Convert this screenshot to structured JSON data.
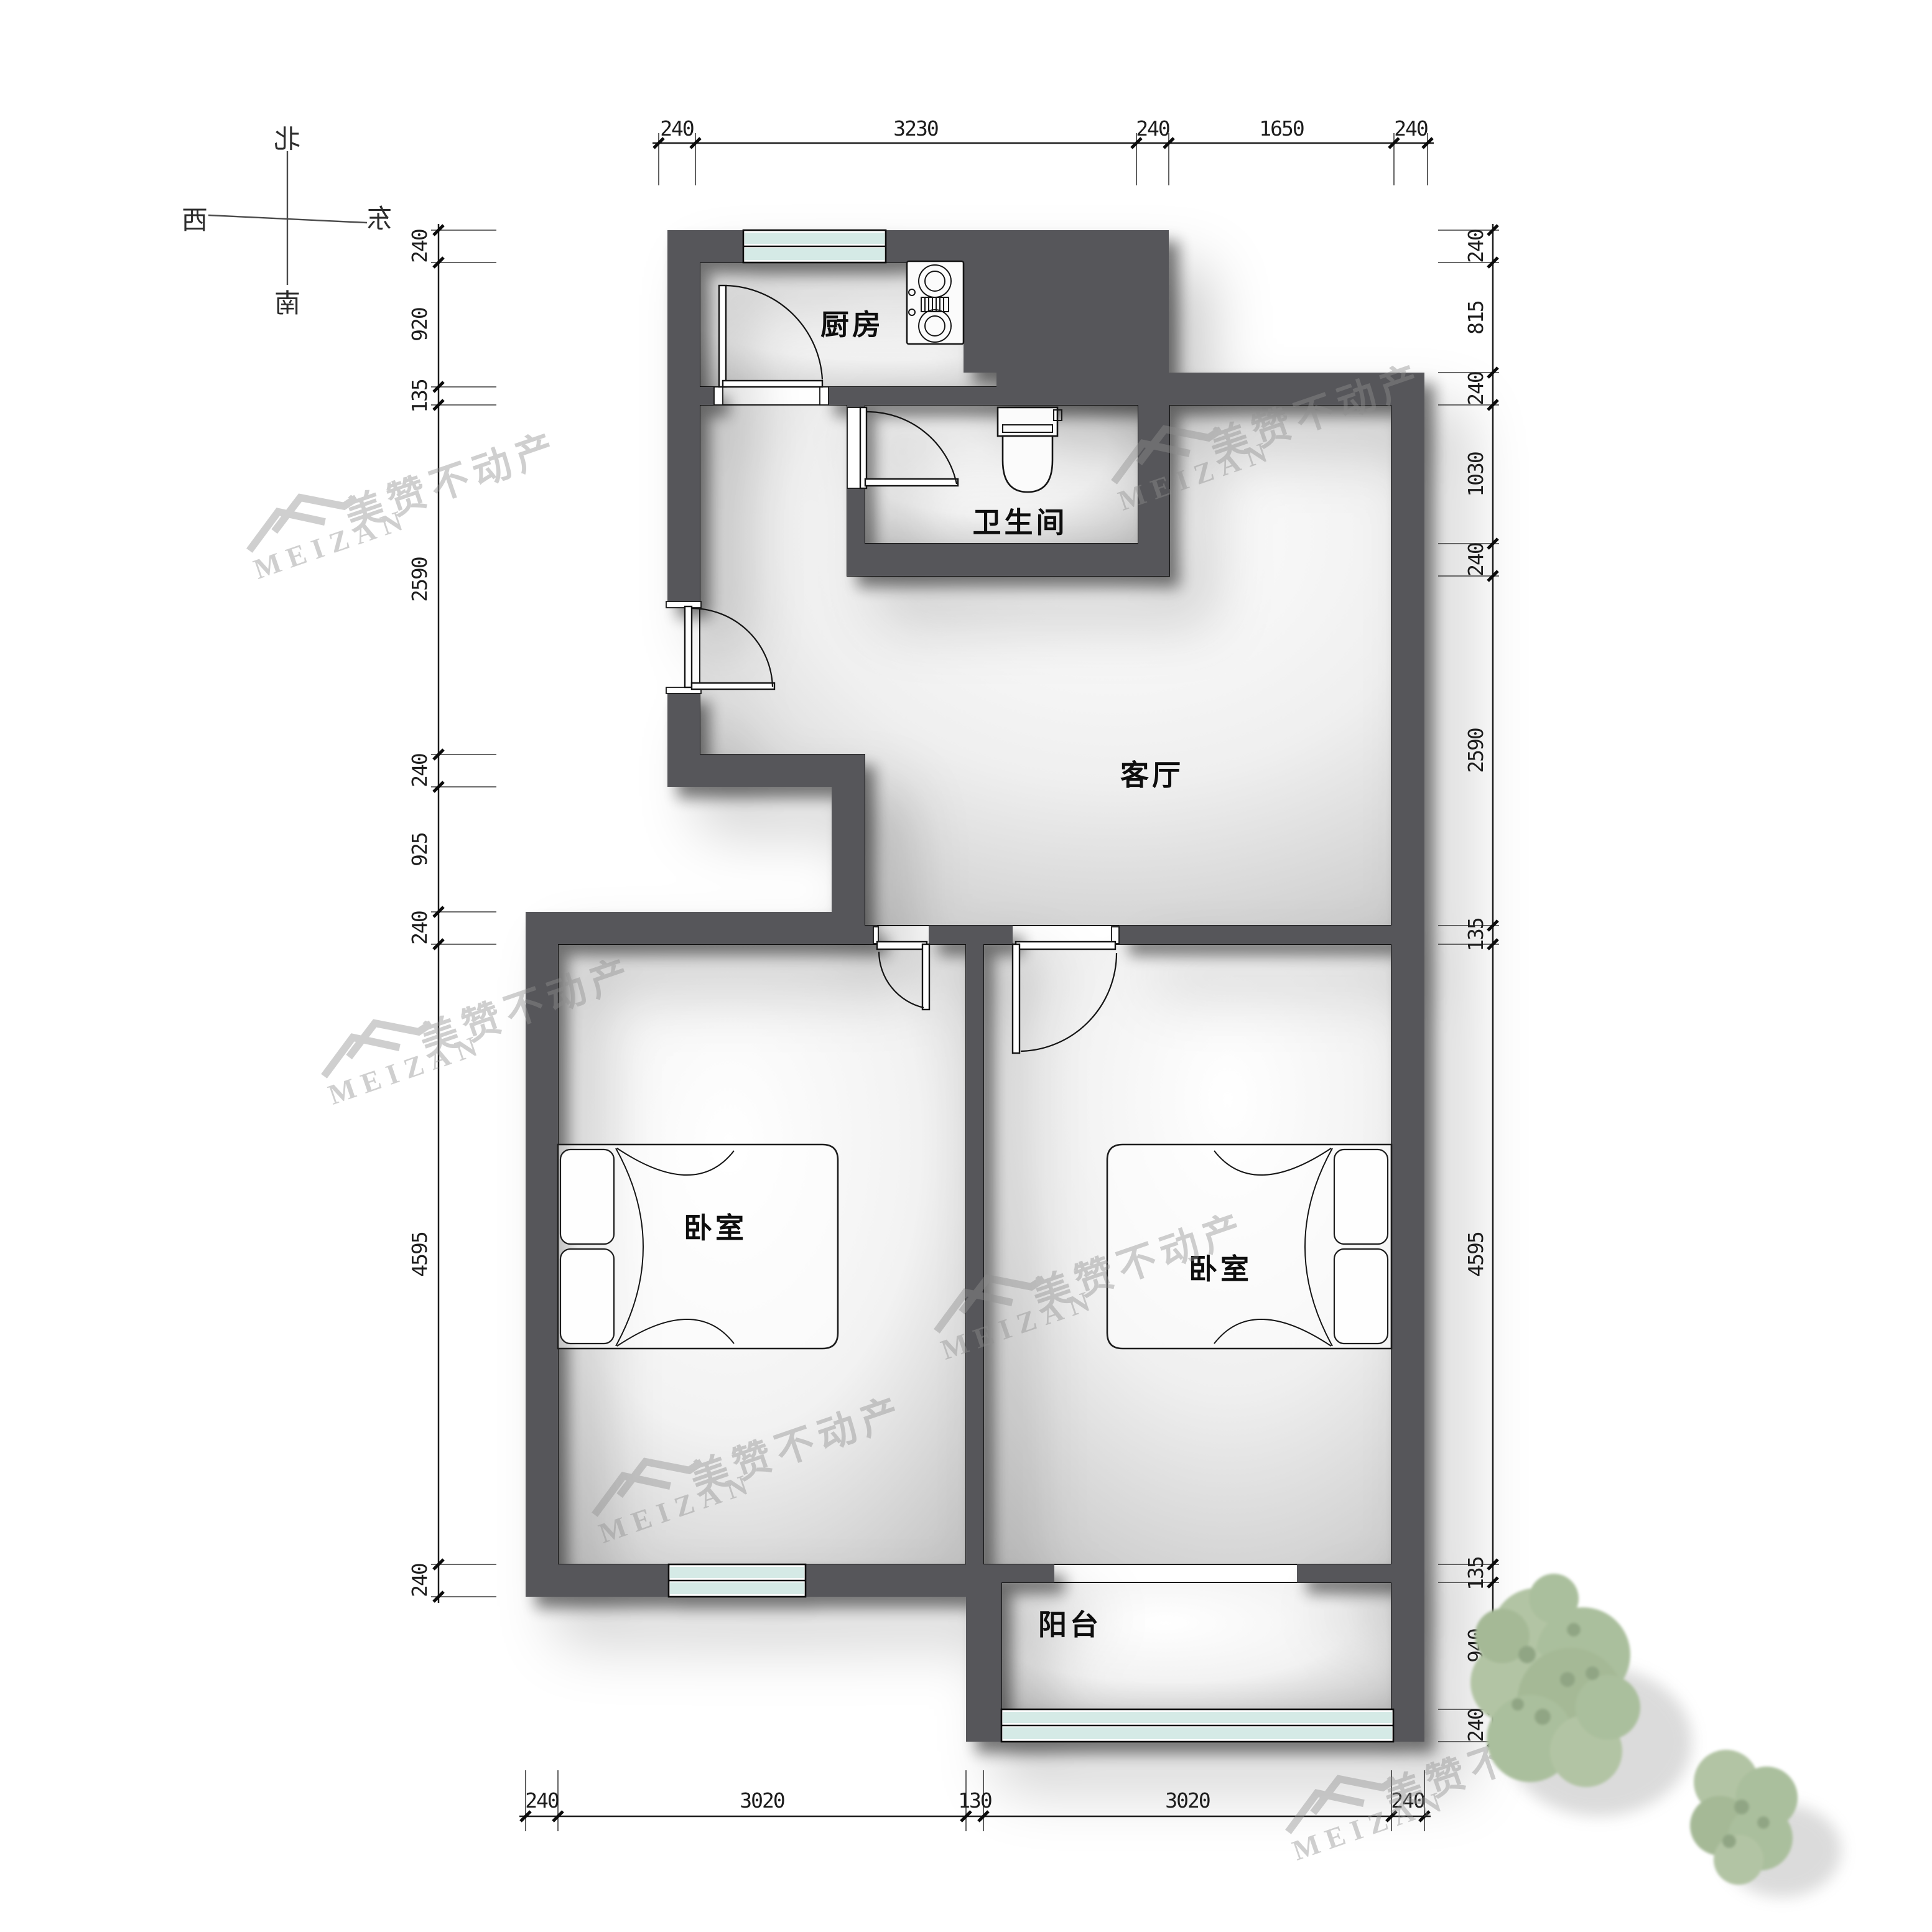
{
  "compass": {
    "north": "北",
    "south": "南",
    "west": "西",
    "east": "东"
  },
  "rooms": [
    {
      "id": "kitchen",
      "label": "厨房"
    },
    {
      "id": "bathroom",
      "label": "卫生间"
    },
    {
      "id": "living-room",
      "label": "客厅"
    },
    {
      "id": "bedroom-left",
      "label": "卧室"
    },
    {
      "id": "bedroom-right",
      "label": "卧室"
    },
    {
      "id": "balcony",
      "label": "阳台"
    }
  ],
  "dimensions": {
    "top": [
      "240",
      "3230",
      "240",
      "1650",
      "240"
    ],
    "bottom": [
      "240",
      "3020",
      "130",
      "3020",
      "240"
    ],
    "left": [
      "240",
      "920",
      "135",
      "2590",
      "240",
      "925",
      "240",
      "4595",
      "240"
    ],
    "right": [
      "240",
      "815",
      "240",
      "1030",
      "240",
      "2590",
      "135",
      "4595",
      "135",
      "940",
      "240"
    ]
  },
  "watermark": {
    "brand_en": "MEIZAN",
    "brand_zh": "美赞不动产"
  },
  "colors": {
    "wall": "#56565a",
    "window_glass": "#d5eae6",
    "tree": "#aabf9d",
    "watermark": "#8f8f8f"
  }
}
